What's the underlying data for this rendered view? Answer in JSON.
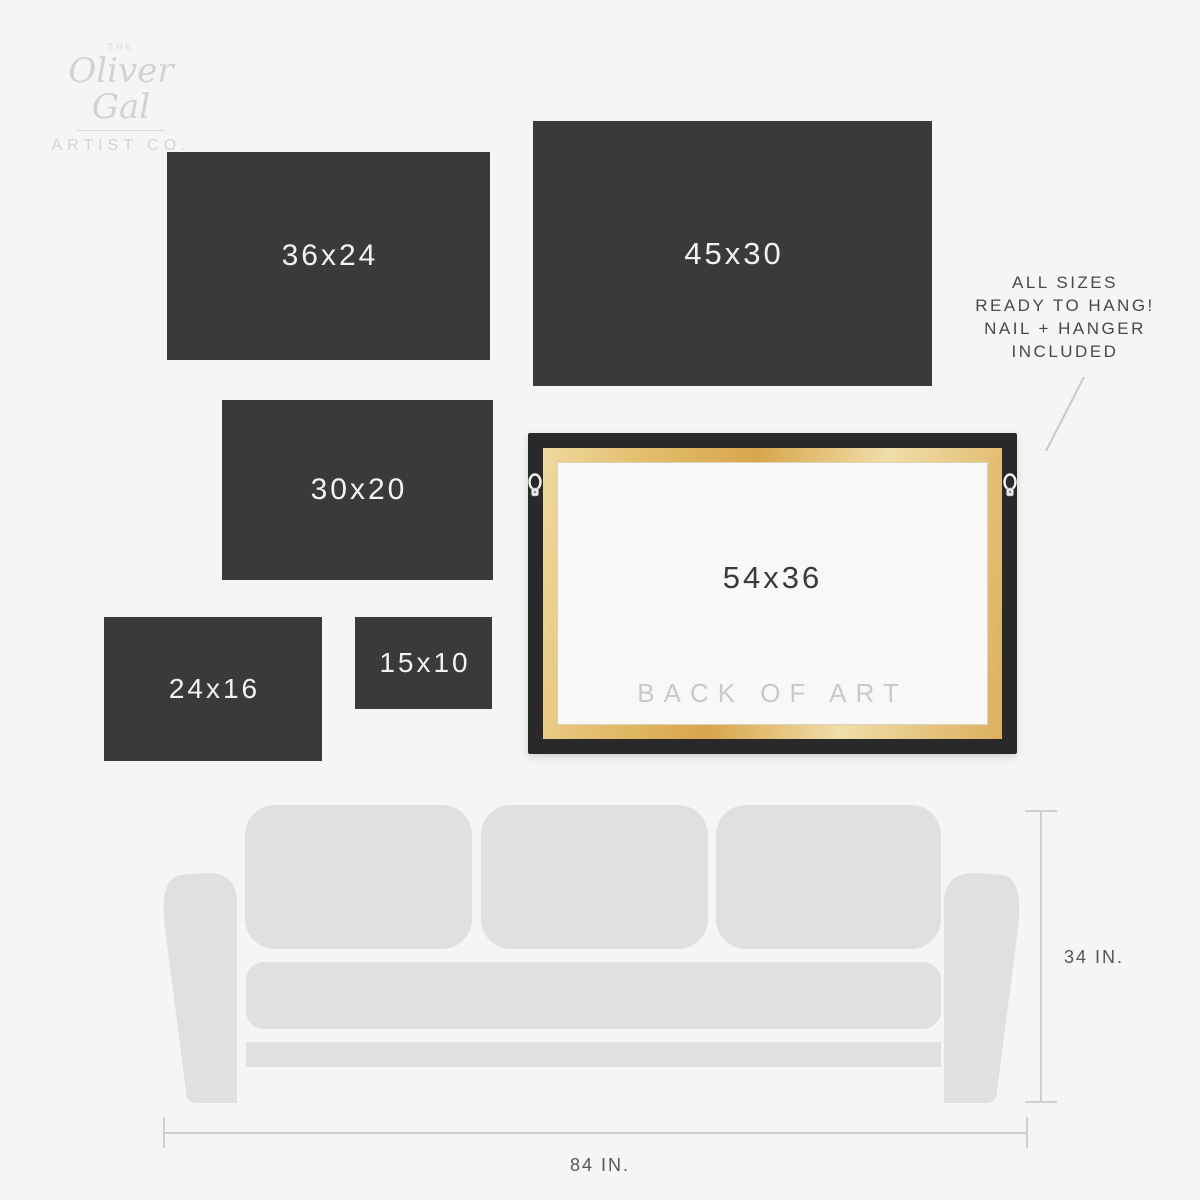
{
  "logo": {
    "the": "THE",
    "name": "Oliver Gal",
    "subtitle": "ARTIST CO."
  },
  "sizes": [
    {
      "label": "36x24"
    },
    {
      "label": "45x30"
    },
    {
      "label": "30x20"
    },
    {
      "label": "24x16"
    },
    {
      "label": "15x10"
    }
  ],
  "frame": {
    "size_label": "54x36",
    "back_label": "BACK OF ART"
  },
  "note": {
    "line1": "ALL SIZES",
    "line2": "READY TO HANG!",
    "line3": "NAIL + HANGER",
    "line4": "INCLUDED"
  },
  "measurements": {
    "couch_height": "34 IN.",
    "couch_width": "84 IN."
  },
  "colors": {
    "background": "#f5f5f4",
    "panel": "#3a3a3c",
    "panel_text": "#f2f2f2",
    "frame_border": "#29292b",
    "wood": "#dcae55",
    "canvas_back": "#f8f8f7",
    "couch": "#e0e0e1",
    "measure_line": "#d0d0d0",
    "note_text": "#48484a",
    "logo_gray": "#d2d2d2"
  }
}
